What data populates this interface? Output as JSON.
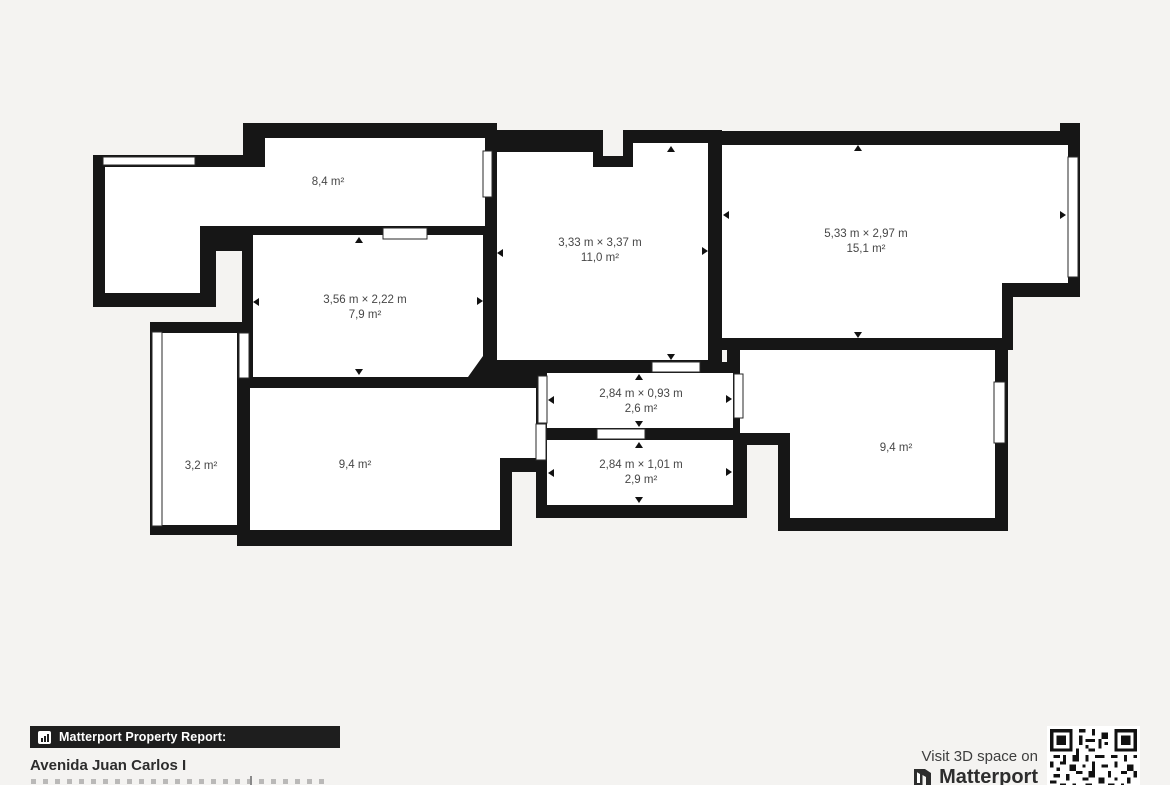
{
  "colors": {
    "background": "#f4f3f1",
    "wall": "#161616",
    "room_fill": "#ffffff",
    "label_text": "#474747",
    "badge_bg": "#1e1e1e"
  },
  "plan": {
    "rooms": {
      "storage_top_left": {
        "area": "8,4 m²"
      },
      "center_room": {
        "dims": "3,33 m × 3,37 m",
        "area": "11,0 m²"
      },
      "right_room": {
        "dims": "5,33 m × 2,97 m",
        "area": "15,1 m²"
      },
      "mid_left_room": {
        "dims": "3,56 m × 2,22 m",
        "area": "7,9 m²"
      },
      "hall_upper": {
        "dims": "2,84 m × 0,93 m",
        "area": "2,6 m²"
      },
      "hall_lower": {
        "dims": "2,84 m × 1,01 m",
        "area": "2,9 m²"
      },
      "balcony_left": {
        "area": "3,2 m²"
      },
      "bottom_center_room": {
        "area": "9,4 m²"
      },
      "bottom_right_room": {
        "area": "9,4 m²"
      }
    }
  },
  "footer": {
    "badge_label": "Matterport Property Report:",
    "address": "Avenida Juan Carlos I",
    "visit_text": "Visit 3D space on",
    "brand": "Matterport"
  }
}
